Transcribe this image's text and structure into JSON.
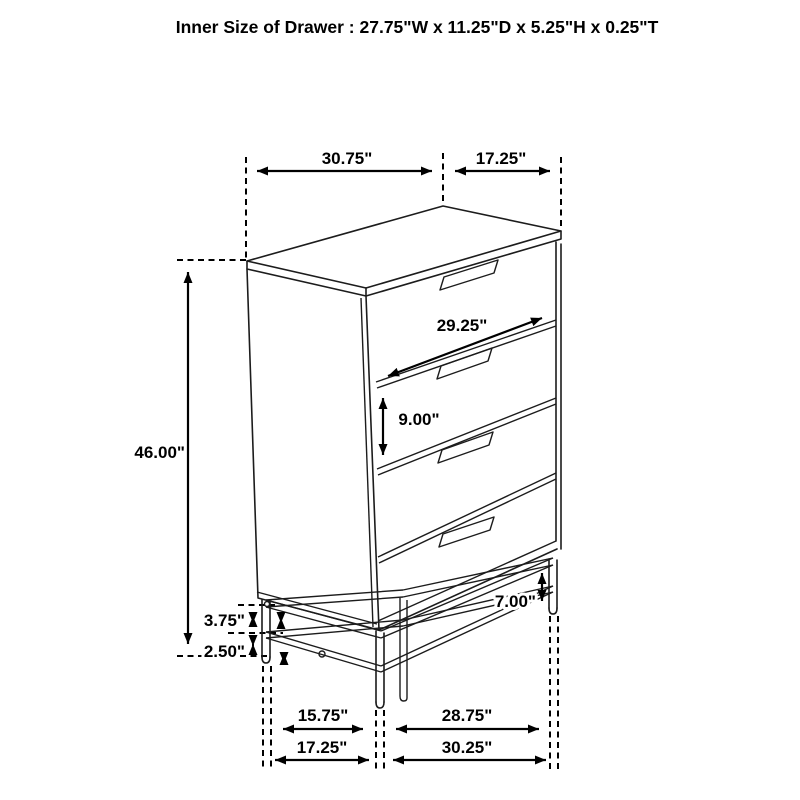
{
  "title": "Inner Size of Drawer : 27.75\"W x 11.25\"D x 5.25\"H x 0.25\"T",
  "dimensions": {
    "top_width": "30.75\"",
    "top_depth": "17.25\"",
    "drawer_front_width": "29.25\"",
    "drawer_front_height": "9.00\"",
    "overall_height": "46.00\"",
    "base_rail_height": "3.75\"",
    "base_clearance": "2.50\"",
    "base_total_height": "7.00\"",
    "base_inner_depth": "15.75\"",
    "base_inner_width": "28.75\"",
    "base_outer_depth": "17.25\"",
    "base_outer_width": "30.25\""
  }
}
